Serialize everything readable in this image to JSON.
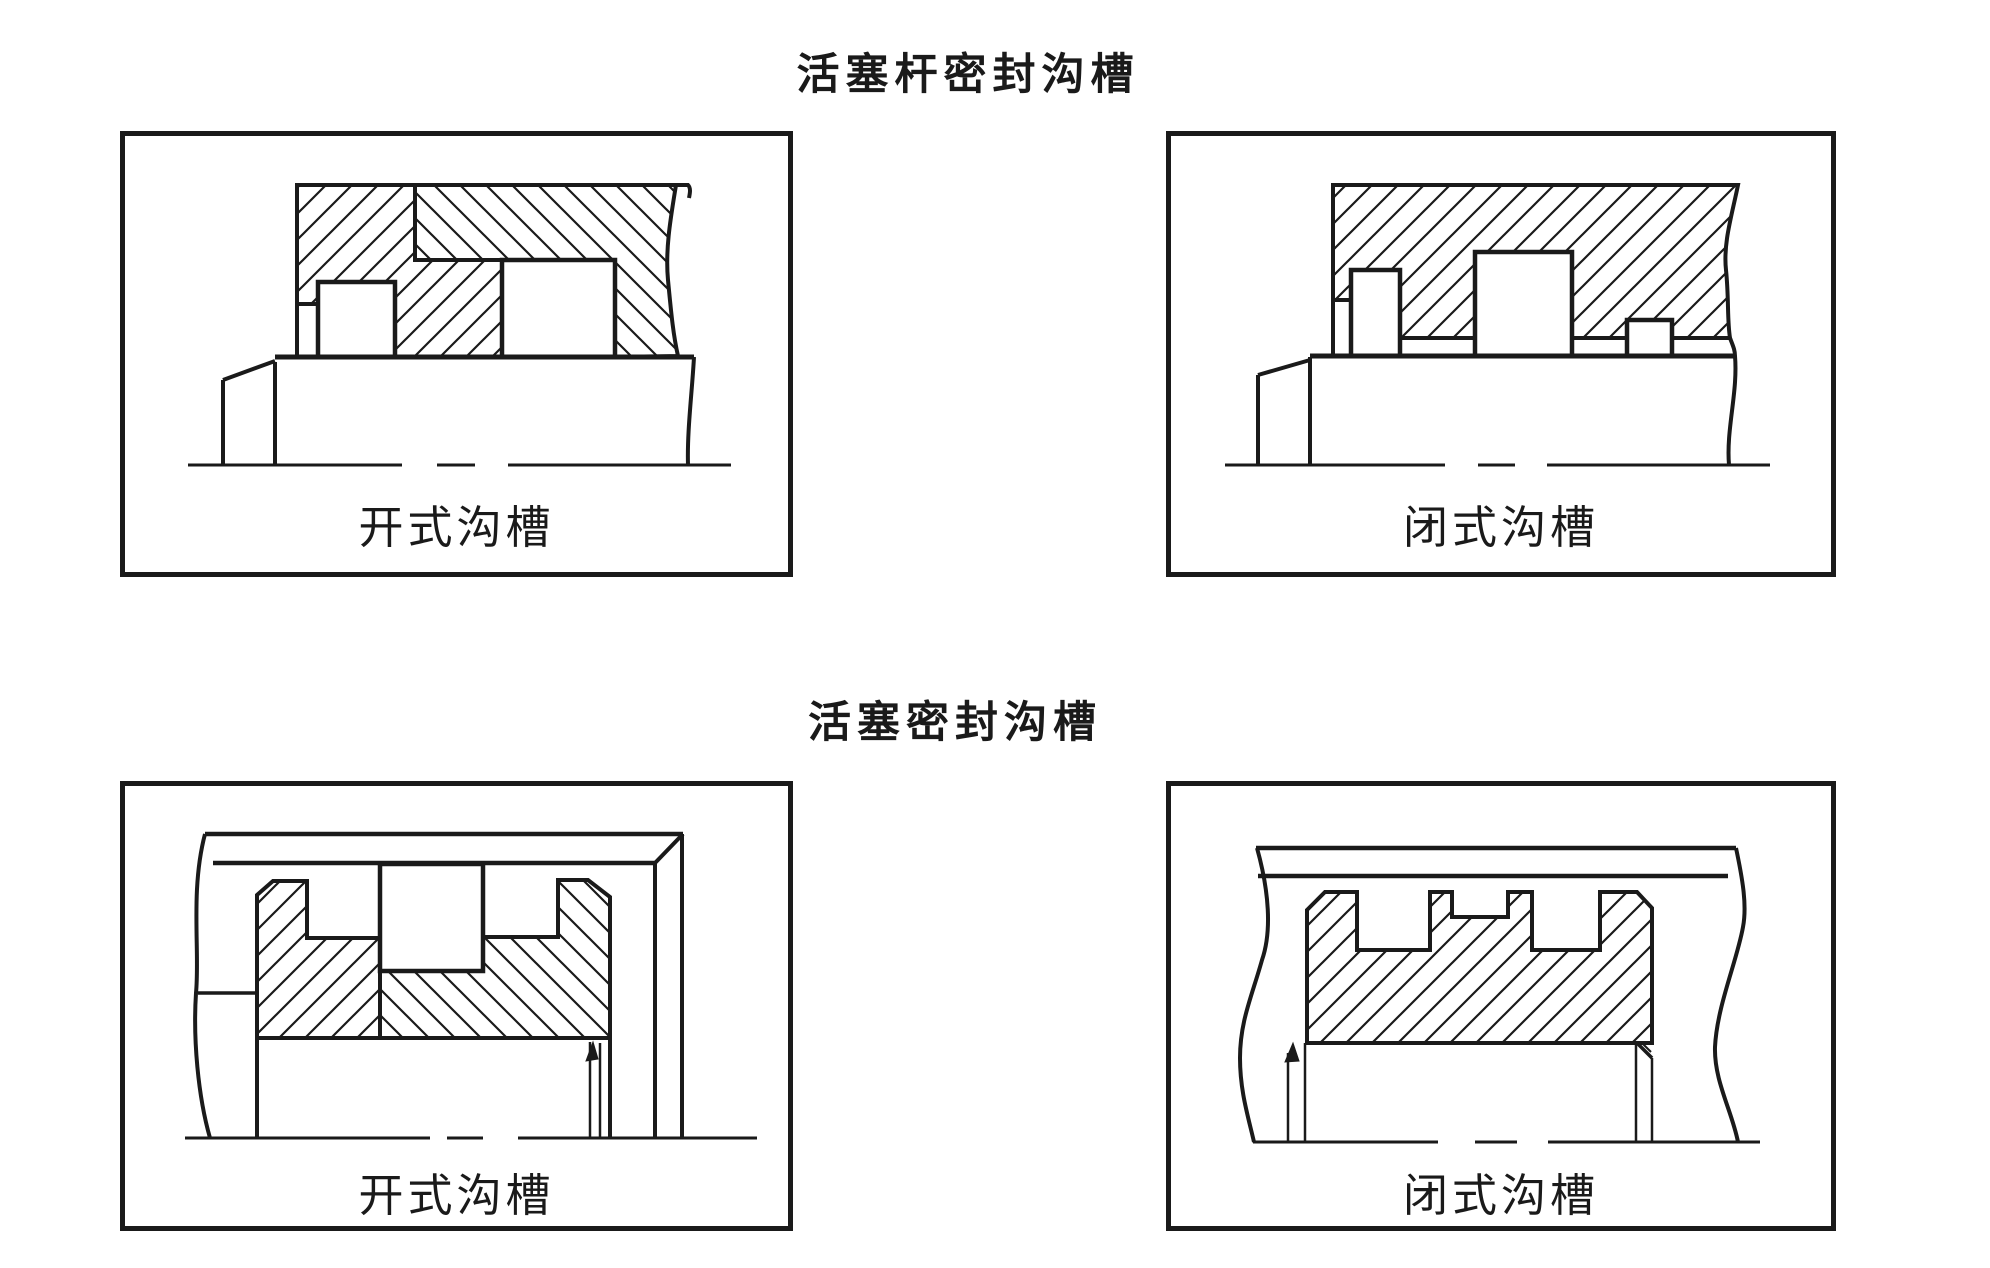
{
  "page": {
    "background": "#ffffff",
    "ink_color": "#1a1a1a"
  },
  "figure": {
    "title_rod_seal": "活塞杆密封沟槽",
    "title_piston_seal": "活塞密封沟槽",
    "panels": [
      {
        "id": "rod-open",
        "group": "活塞杆密封沟槽",
        "label": "开式沟槽",
        "type": "open"
      },
      {
        "id": "rod-closed",
        "group": "活塞杆密封沟槽",
        "label": "闭式沟槽",
        "type": "closed"
      },
      {
        "id": "piston-open",
        "group": "活塞密封沟槽",
        "label": "开式沟槽",
        "type": "open"
      },
      {
        "id": "piston-closed",
        "group": "活塞密封沟槽",
        "label": "闭式沟槽",
        "type": "closed"
      }
    ]
  }
}
